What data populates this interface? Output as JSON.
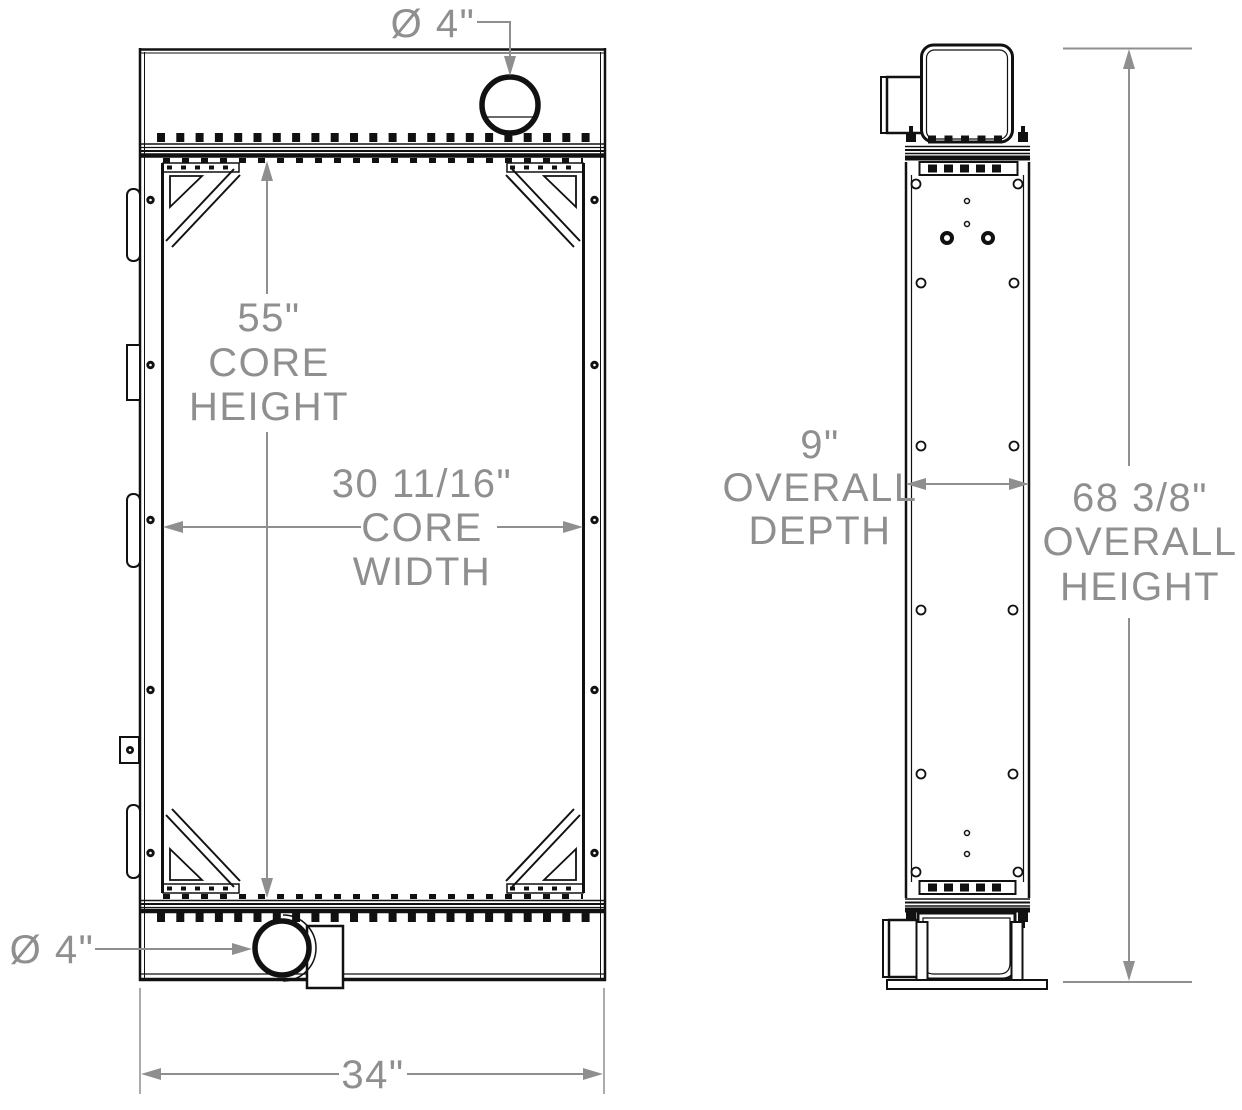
{
  "drawing": {
    "description": "Radiator technical drawing, front and side elevation views",
    "colors": {
      "line": "#111111",
      "dimension": "#8f8f8f",
      "background": "#ffffff"
    },
    "labels": {
      "top_port": {
        "value": "Ø 4\""
      },
      "bottom_port": {
        "value": "Ø 4\""
      },
      "core_height": {
        "value": "55\"",
        "line2": "CORE",
        "line3": "HEIGHT"
      },
      "core_width": {
        "value": "30 11/16\"",
        "line2": "CORE",
        "line3": "WIDTH"
      },
      "overall_width": {
        "value": "34\""
      },
      "overall_depth": {
        "value": "9\"",
        "line2": "OVERALL",
        "line3": "DEPTH"
      },
      "overall_height": {
        "value": "68 3/8\"",
        "line2": "OVERALL",
        "line3": "HEIGHT"
      }
    }
  }
}
